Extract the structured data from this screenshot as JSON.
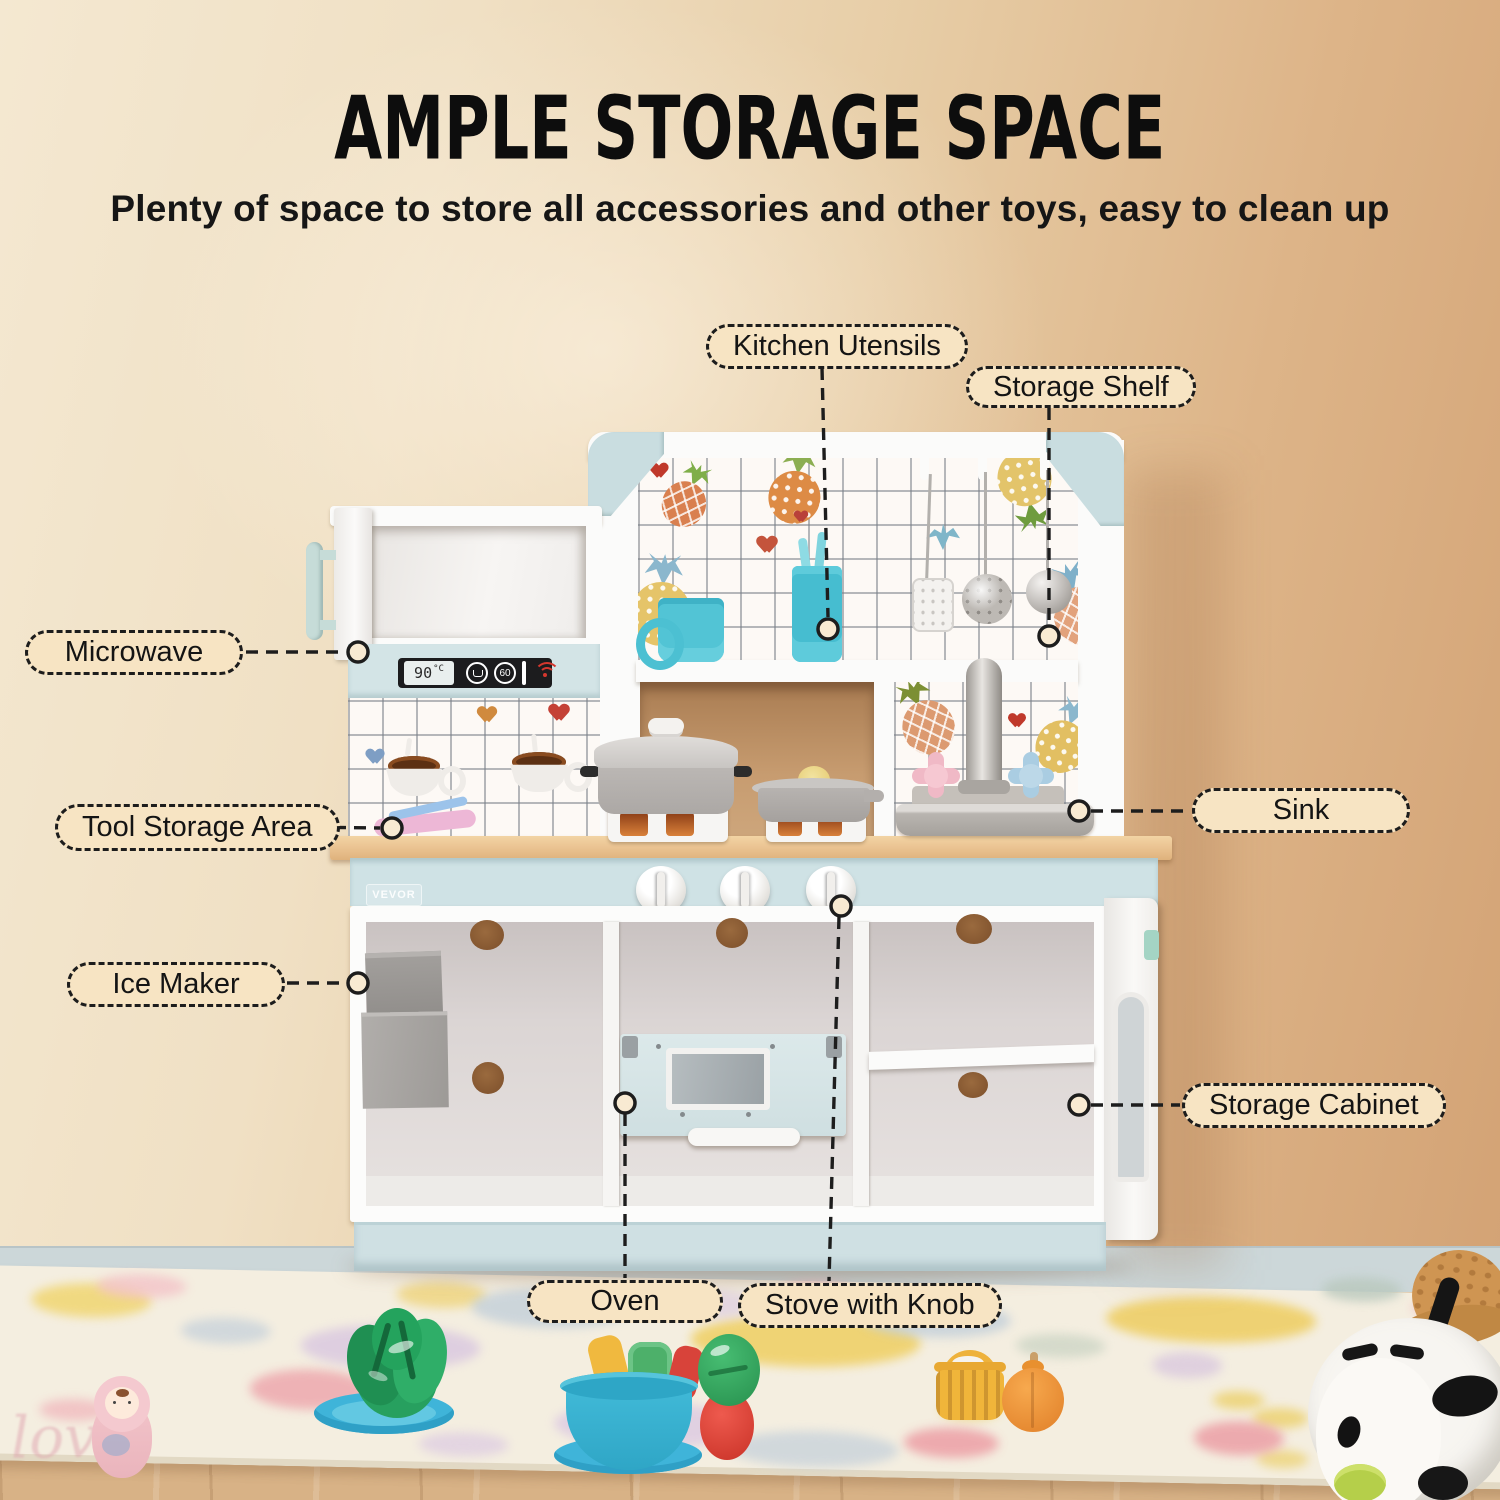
{
  "header": {
    "title": "AMPLE STORAGE SPACE",
    "subtitle": "Plenty of space to store all accessories and other toys, easy to clean up"
  },
  "callouts": {
    "kitchen_utensils": "Kitchen Utensils",
    "storage_shelf": "Storage Shelf",
    "microwave": "Microwave",
    "tool_storage_area": "Tool Storage Area",
    "sink": "Sink",
    "ice_maker": "Ice Maker",
    "storage_cabinet": "Storage Cabinet",
    "oven": "Oven",
    "stove_with_knob": "Stove with Knob"
  },
  "product": {
    "brand": "VEVOR",
    "microwave_display": "90",
    "microwave_display_unit": "°C",
    "microwave_button_label": "60",
    "rug_text": "love"
  },
  "icons": {
    "microwave_panel": [
      "steam-cup-icon",
      "timer-60-icon",
      "wifi-signal-icon"
    ]
  },
  "colors": {
    "wall_left": "#f4e8d1",
    "wall_right": "#d2a173",
    "label_fill": "#f7e4c3",
    "leader_line": "#1d1d1d",
    "kitchen_blue": "#cfe2e5",
    "counter_wood": "#ebc493",
    "backsplash_grid": "#7a8088",
    "cup_teal": "#52c4d5"
  }
}
